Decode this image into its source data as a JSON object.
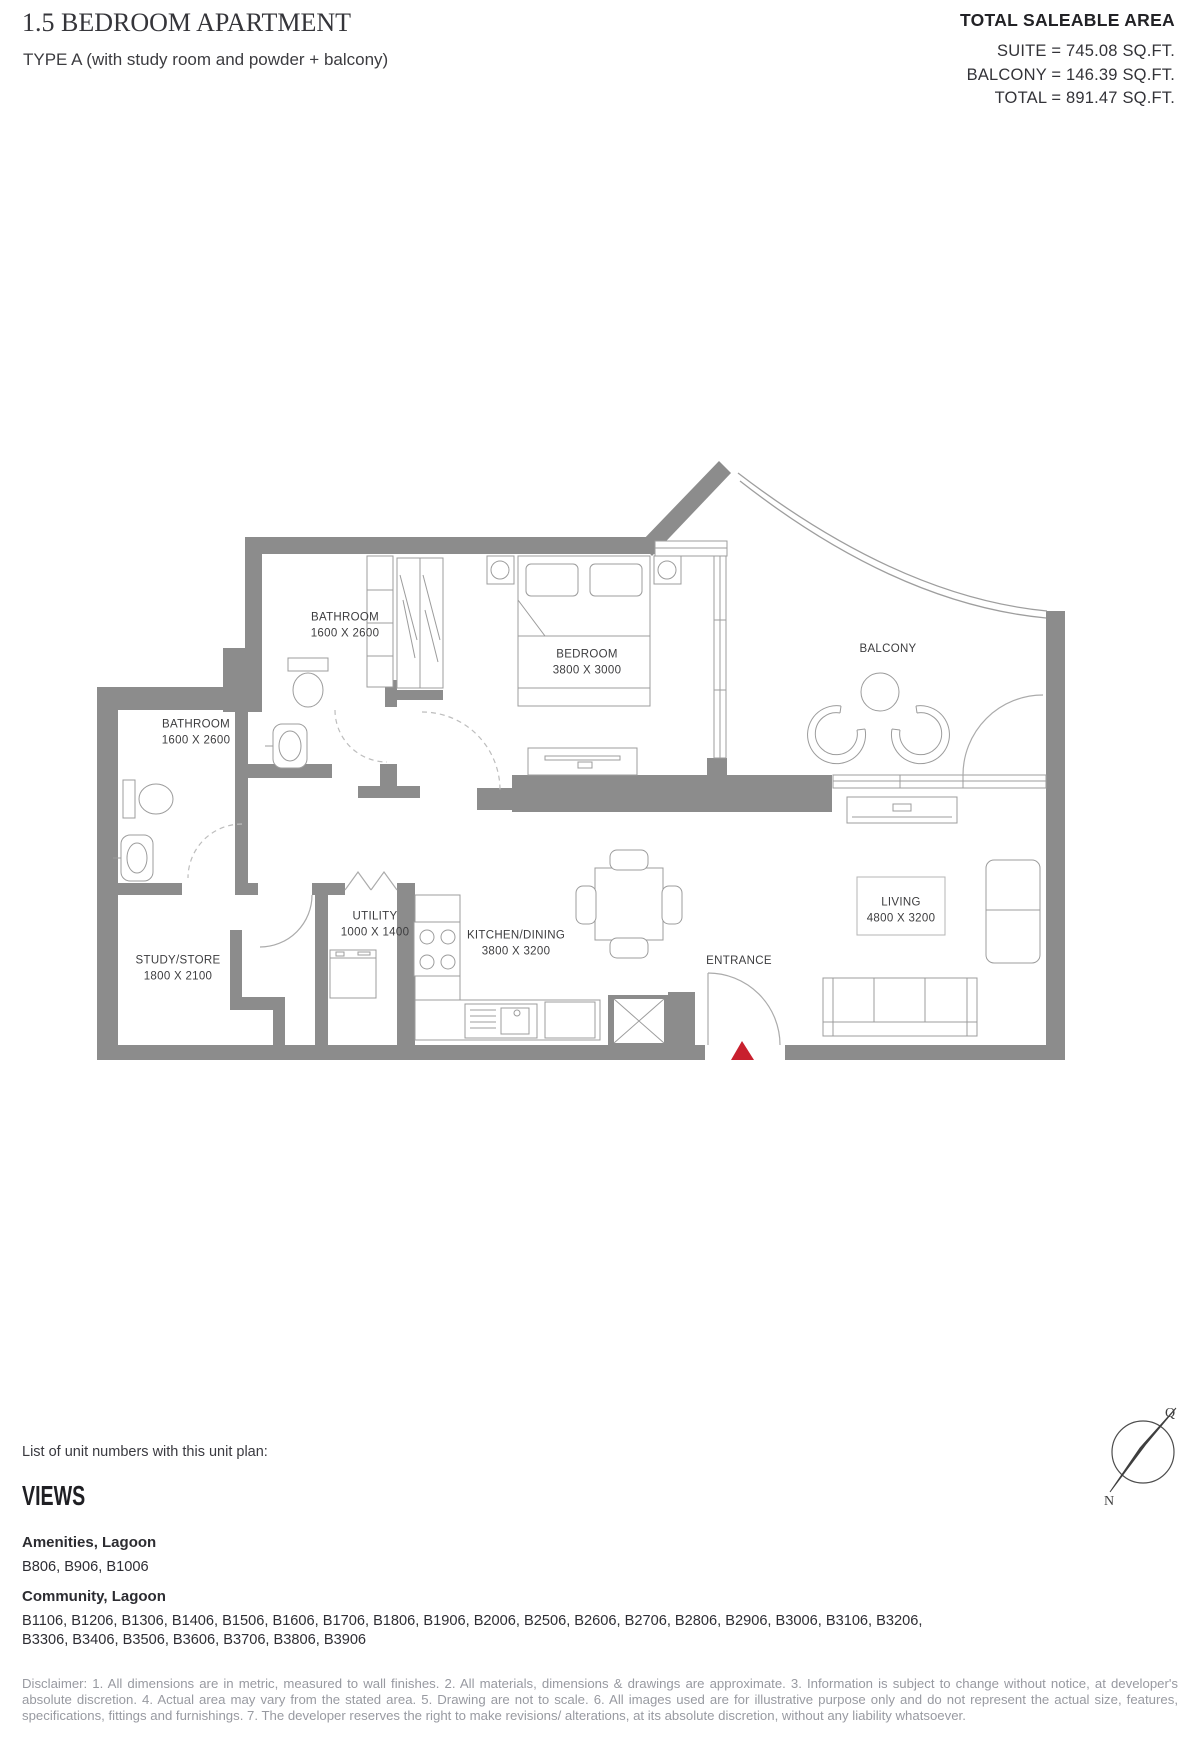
{
  "header": {
    "title": "1.5 BEDROOM APARTMENT",
    "subtitle": "TYPE A (with study room and powder + balcony)",
    "area": {
      "heading": "TOTAL SALEABLE AREA",
      "lines": [
        "SUITE = 745.08 SQ.FT.",
        "BALCONY = 146.39 SQ.FT.",
        "TOTAL = 891.47 SQ.FT."
      ]
    }
  },
  "floorplan": {
    "wall_color": "#8c8c8c",
    "line_color": "#9c9c9c",
    "entrance_marker_color": "#c8202e",
    "rooms": [
      {
        "name": "BATHROOM",
        "dims": "1600 X 2600"
      },
      {
        "name": "BATHROOM",
        "dims": "1600 X 2600"
      },
      {
        "name": "BEDROOM",
        "dims": "3800 X 3000"
      },
      {
        "name": "BALCONY",
        "dims": ""
      },
      {
        "name": "STUDY/STORE",
        "dims": "1800 X 2100"
      },
      {
        "name": "UTILITY",
        "dims": "1000 X 1400"
      },
      {
        "name": "KITCHEN/DINING",
        "dims": "3800 X 3200"
      },
      {
        "name": "LIVING",
        "dims": "4800 X 3200"
      },
      {
        "name": "ENTRANCE",
        "dims": ""
      }
    ]
  },
  "units": {
    "intro": "List of unit numbers with this unit plan:",
    "views_heading": "VIEWS",
    "groups": [
      {
        "view": "Amenities, Lagoon",
        "units": "B806, B906, B1006"
      },
      {
        "view": "Community, Lagoon",
        "units": "B1106, B1206, B1306, B1406, B1506, B1606, B1706, B1806, B1906, B2006, B2506, B2606, B2706, B2806, B2906, B3006, B3106, B3206, B3306, B3406, B3506, B3606, B3706, B3806, B3906"
      }
    ]
  },
  "compass": {
    "q_label": "Q",
    "north_label": "N"
  },
  "disclaimer": "Disclaimer: 1. All dimensions are in metric, measured to wall finishes. 2. All materials, dimensions & drawings are approximate. 3. Information is subject to change without notice, at developer's absolute discretion. 4. Actual area may vary from the stated area. 5. Drawing are not to scale. 6. All images used are for illustrative purpose only and do not represent the actual size, features, specifications, fittings and furnishings. 7. The developer reserves the right to make revisions/ alterations, at its absolute discretion, without any liability whatsoever."
}
